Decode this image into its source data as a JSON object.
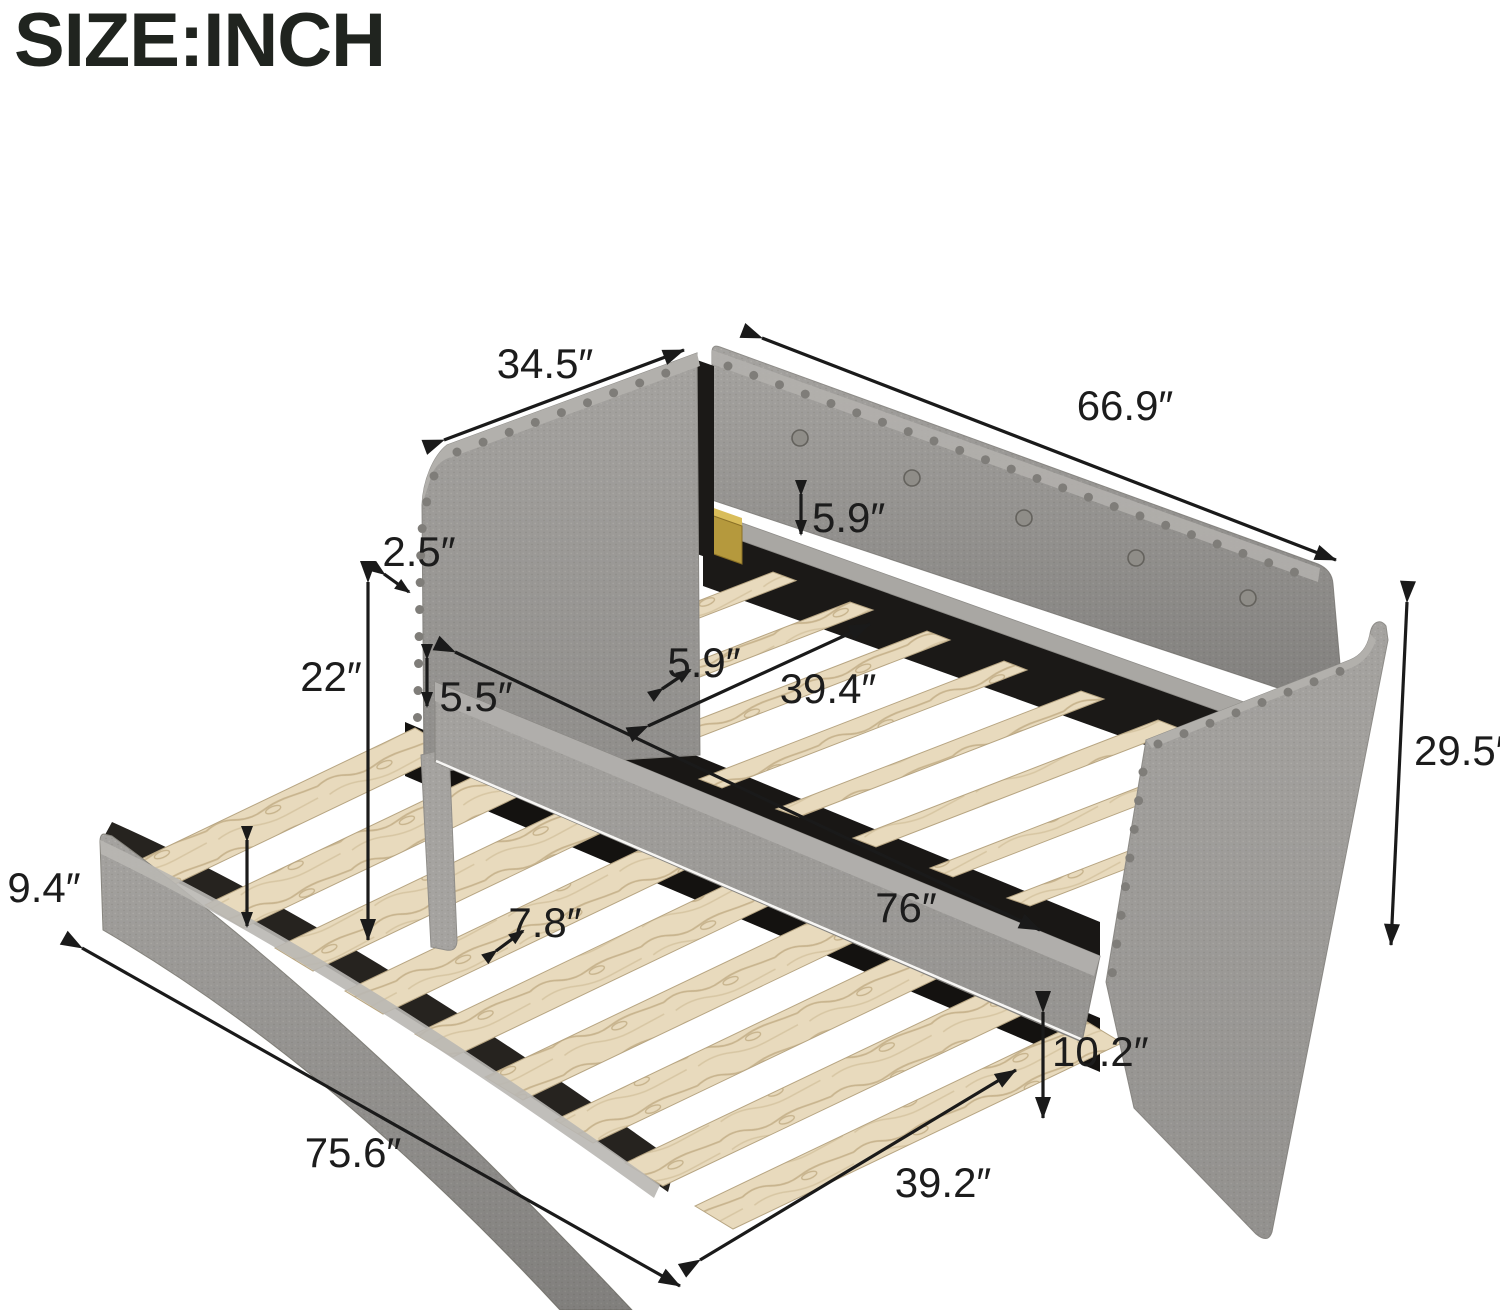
{
  "title": "SIZE:INCH",
  "unit_system": "inch",
  "figure": "daybed-with-trundle-dimension-diagram",
  "dims": {
    "arm_side_depth": "34.5″",
    "back_length": "66.9″",
    "back_rail_height": "5.9″",
    "arm_top_thickness": "2.5″",
    "arm_height": "22″",
    "side_rail_height": "5.5″",
    "upper_slat_gap": "5.9″",
    "upper_bed_width": "39.4″",
    "overall_height": "29.5″",
    "trundle_panel_height": "9.4″",
    "trundle_slat_gap": "7.8″",
    "upper_bed_length": "76″",
    "trundle_clearance_height": "10.2″",
    "trundle_length": "75.6″",
    "trundle_width": "39.2″"
  },
  "colors": {
    "fabric_gray": "#a5a3a0",
    "fabric_dark": "#8b8984",
    "wood_slat": "#e8dabd",
    "interior_black": "#1b1917",
    "bracket_gold": "#b5993d",
    "dimension_ink": "#1a1a1a"
  }
}
